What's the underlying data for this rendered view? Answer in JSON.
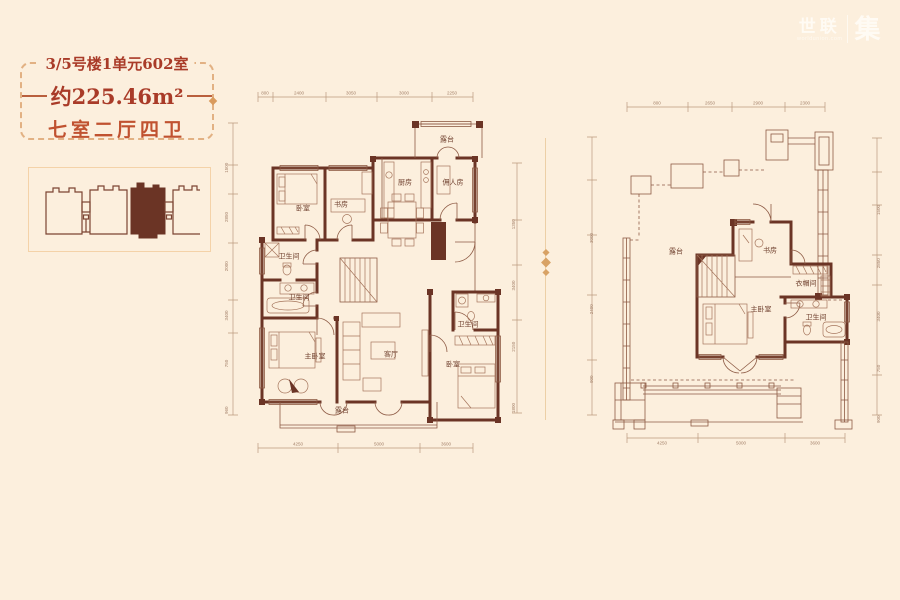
{
  "page": {
    "background": "#fcefdd"
  },
  "logo": {
    "brand": "世联",
    "domain": "worldunion.com",
    "mark": "集"
  },
  "info_card": {
    "title": "3/5号楼1单元602室",
    "area": "约225.46m²",
    "layout": "七室二厅四卫"
  },
  "floor1": {
    "rooms": [
      "露台",
      "厨房",
      "佣人房",
      "书房",
      "卧室",
      "卫生间",
      "卫生间",
      "卫生间",
      "主卧室",
      "客厅",
      "卧室",
      "露台"
    ],
    "dims_top": [
      "800",
      "2400",
      "3050",
      "3000",
      "2250"
    ],
    "dims_bottom": [
      "4250",
      "5000",
      "3600"
    ],
    "dims_left": "960 750 3400 2000 2850 1500",
    "dims_right": "1800 2150 3400 1350"
  },
  "floor2": {
    "rooms": [
      "露台",
      "书房",
      "衣帽间",
      "主卧室",
      "卫生间"
    ],
    "dims_top": [
      "800",
      "2650",
      "2900",
      "2300"
    ],
    "dims_bottom": [
      "4250",
      "5000",
      "3600"
    ],
    "dims_left": "900 2400 3000",
    "dims_right": "900 750 3400 2850 1500"
  },
  "colors": {
    "wall": "#6b3425",
    "accent_red": "#a93b28",
    "card_border": "#e2b183"
  }
}
